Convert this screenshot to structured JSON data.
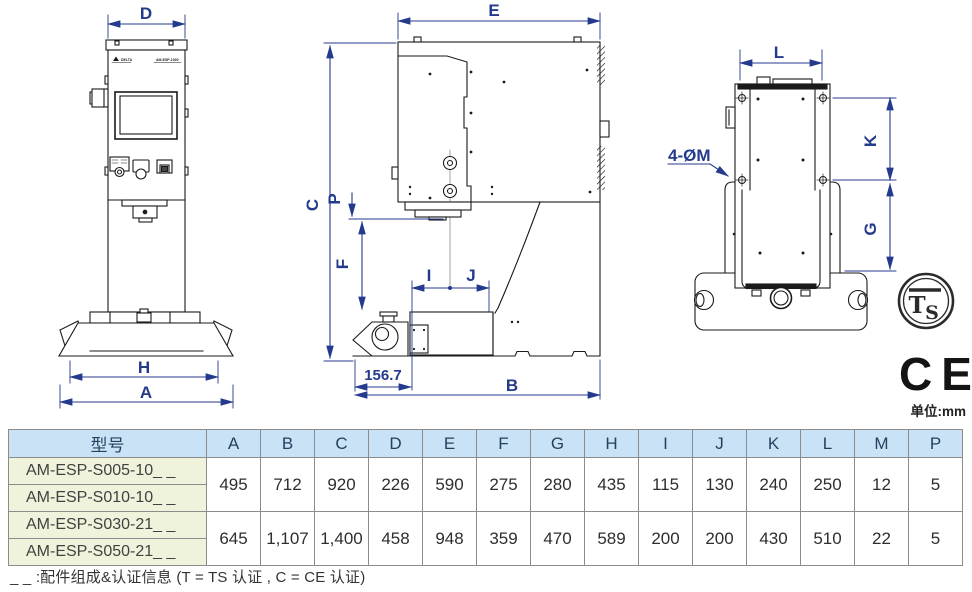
{
  "dims": {
    "D": "D",
    "E": "E",
    "L": "L",
    "C": "C",
    "P": "P",
    "F": "F",
    "I": "I",
    "J": "J",
    "K": "K",
    "G": "G",
    "H": "H",
    "A": "A",
    "B": "B",
    "throat": "156.7",
    "holes": "4-ØM"
  },
  "nameplate": {
    "brand": "DELTA",
    "model": "AM-ESP-1000"
  },
  "cert": {
    "ts_t": "T",
    "ts_s": "S",
    "ce": "CE"
  },
  "unit_note": "单位:mm",
  "table": {
    "headers": [
      "型号",
      "A",
      "B",
      "C",
      "D",
      "E",
      "F",
      "G",
      "H",
      "I",
      "J",
      "K",
      "L",
      "M",
      "P"
    ],
    "groups": [
      {
        "models": [
          "AM-ESP-S005-10_ _",
          "AM-ESP-S010-10_ _"
        ],
        "values": [
          "495",
          "712",
          "920",
          "226",
          "590",
          "275",
          "280",
          "435",
          "115",
          "130",
          "240",
          "250",
          "12",
          "5"
        ]
      },
      {
        "models": [
          "AM-ESP-S030-21_ _",
          "AM-ESP-S050-21_ _"
        ],
        "values": [
          "645",
          "1,107",
          "1,400",
          "458",
          "948",
          "359",
          "470",
          "589",
          "200",
          "200",
          "430",
          "510",
          "22",
          "5"
        ]
      }
    ]
  },
  "footnote": "_ _ :配件组成&认证信息 (T = TS 认证 , C = CE 认证)"
}
